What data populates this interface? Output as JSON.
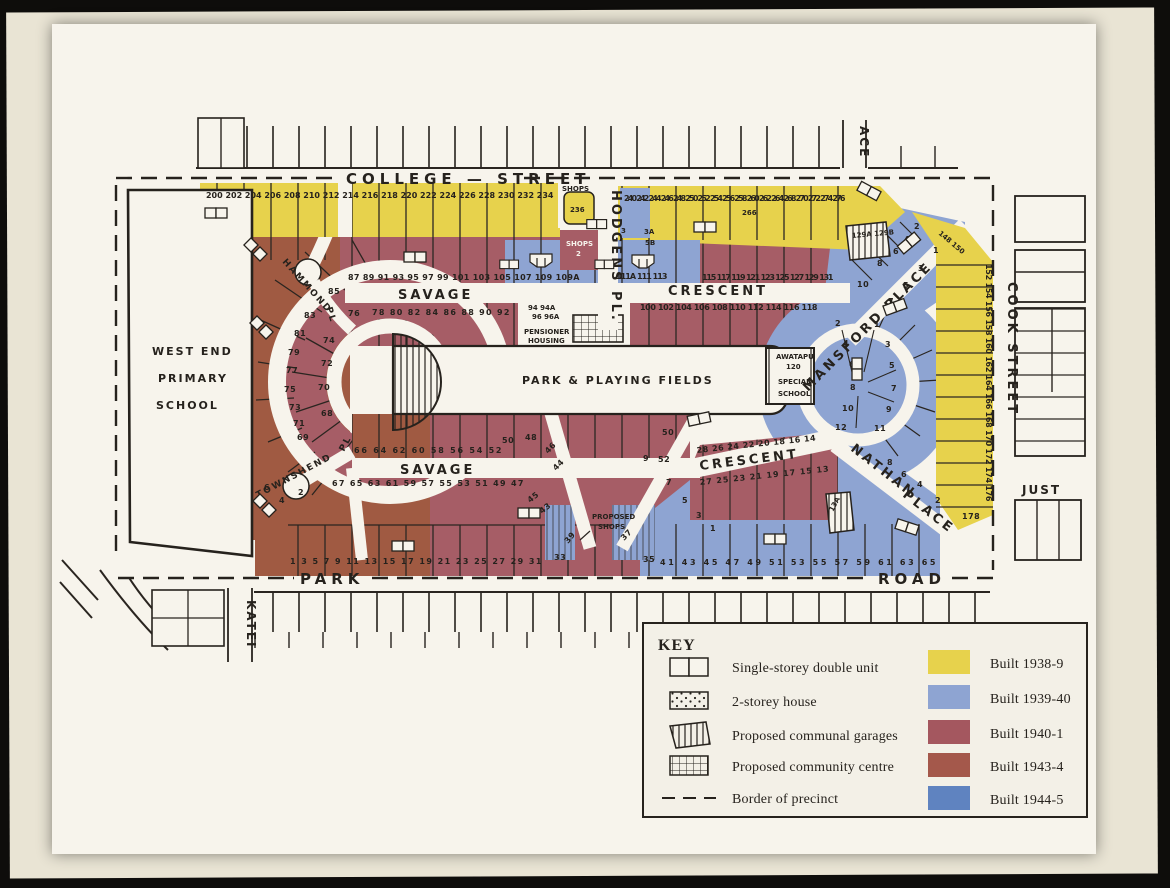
{
  "streets": {
    "college": "COLLEGE — STREET",
    "hodgens": "HODGENS PL.",
    "mansford": "MANSFORD PLACE",
    "cook": "COOK STREET",
    "savage_upper": "SAVAGE",
    "crescent_upper": "CRESCENT",
    "savage_lower": "SAVAGE",
    "crescent_lower": "CRESCENT",
    "nathan_word1": "NATHAN",
    "nathan_word2": "PLACE",
    "hammond": "HAMMOND",
    "hammond_pl": "PL",
    "townshend": "TOWNSHEND",
    "townshend_pl": "PL",
    "park": "PARK",
    "road": "ROAD",
    "katei": "KATEI",
    "just": "JUST",
    "ace_partial": "ACE"
  },
  "labels": {
    "school_line1": "WEST END",
    "school_line2": "PRIMARY",
    "school_line3": "SCHOOL",
    "park_fields": "PARK & PLAYING FIELDS",
    "pensioner_line1": "PENSIONER",
    "pensioner_line2": "HOUSING",
    "awatapu_line1": "AWATAPU",
    "awatapu_line2": "120",
    "awatapu_line3": "SPECIAL",
    "awatapu_line4": "SCHOOL",
    "proposed_shops_line1": "PROPOSED",
    "proposed_shops_line2": "SHOPS",
    "shops_north": "SHOPS",
    "shops2_line1": "SHOPS",
    "shops2_line2": "2",
    "lot_236": "236",
    "lot_266": "266"
  },
  "lots": {
    "college_west": [
      "200",
      "202",
      "204",
      "206",
      "208",
      "210",
      "212",
      "214",
      "216",
      "218",
      "220",
      "222",
      "224",
      "226",
      "228",
      "230",
      "232",
      "234"
    ],
    "college_east": [
      "240",
      "242",
      "244",
      "246",
      "248",
      "250",
      "252",
      "254",
      "256",
      "258",
      "260",
      "262",
      "264",
      "268",
      "270",
      "272",
      "274",
      "276"
    ],
    "cook_top": [
      "148",
      "150"
    ],
    "cook_strip": [
      "152",
      "154",
      "156",
      "158",
      "160",
      "162",
      "164",
      "166",
      "168",
      "170",
      "172",
      "174",
      "176"
    ],
    "cook_bottom": "178",
    "savage_n_outer_w": [
      "87",
      "89",
      "91",
      "93",
      "95",
      "97",
      "99",
      "101",
      "103",
      "105",
      "107",
      "109",
      "109A"
    ],
    "savage_n_outer_m": [
      "111A",
      "111",
      "113"
    ],
    "savage_n_outer_e": [
      "115",
      "117",
      "119",
      "121",
      "123",
      "125",
      "127",
      "129",
      "131"
    ],
    "garage_lots_n": [
      "129A",
      "129B"
    ],
    "savage_n_inner": [
      "78",
      "80",
      "82",
      "84",
      "86",
      "88",
      "90",
      "92"
    ],
    "pensioner_row1": [
      "94",
      "94A"
    ],
    "pensioner_row2": [
      "96",
      "96A"
    ],
    "crescent_n_inner": [
      "100",
      "102",
      "104",
      "106",
      "108",
      "110",
      "112",
      "114",
      "116",
      "118"
    ],
    "ring_w_outer": [
      "85",
      "83",
      "81",
      "79",
      "77",
      "75",
      "73",
      "71",
      "69"
    ],
    "ring_w_inner": [
      "76",
      "74",
      "72",
      "70",
      "68"
    ],
    "savage_s_inner": [
      "66",
      "64",
      "62",
      "60",
      "58",
      "56",
      "54",
      "52"
    ],
    "spur_w": [
      "50",
      "48"
    ],
    "spur_e": [
      "50",
      "52"
    ],
    "diag_se": [
      "46",
      "44"
    ],
    "savage_s_outer": [
      "67",
      "65",
      "63",
      "61",
      "59",
      "57",
      "55",
      "53",
      "51",
      "49",
      "47"
    ],
    "diag_s_outer": [
      "45",
      "43"
    ],
    "crescent_s_inner": [
      "28",
      "26",
      "24",
      "22",
      "20",
      "18",
      "16",
      "14"
    ],
    "crescent_s_outer": [
      "27",
      "25",
      "23",
      "21",
      "19",
      "17",
      "15",
      "13"
    ],
    "garage_lot_s": "13A",
    "park_row_west": [
      "1",
      "3",
      "5",
      "7",
      "9",
      "11",
      "13",
      "15",
      "17",
      "19",
      "21",
      "23",
      "25",
      "27",
      "29",
      "31"
    ],
    "shops_corner": [
      "39",
      "37",
      "35",
      "33"
    ],
    "park_row_east": [
      "41",
      "43",
      "45",
      "47",
      "49",
      "51",
      "53",
      "55",
      "57",
      "59",
      "61",
      "63",
      "65"
    ],
    "nathan_sw": [
      "9",
      "7",
      "5",
      "3",
      "1"
    ],
    "nathan_ne": [
      "8",
      "6",
      "4",
      "2"
    ],
    "mansford_nw": [
      "10",
      "8",
      "6",
      "4",
      "2"
    ],
    "mansford_se": [
      "1",
      "3",
      "5",
      "7"
    ],
    "ring_e_inner": [
      "2",
      "4",
      "6",
      "8",
      "10",
      "12"
    ],
    "ring_e_outer": [
      "1",
      "3",
      "5",
      "7",
      "9",
      "11"
    ],
    "hodgens_east": [
      "3",
      "3A",
      "5B"
    ],
    "townshend_lots": [
      "6",
      "4",
      "2"
    ]
  },
  "key": {
    "title": "KEY",
    "symbols": [
      {
        "name": "single-storey-double-unit",
        "label": "Single-storey double unit"
      },
      {
        "name": "two-storey-house",
        "label": "2-storey house"
      },
      {
        "name": "proposed-communal-garages",
        "label": "Proposed communal garages"
      },
      {
        "name": "proposed-community-centre",
        "label": "Proposed community centre"
      },
      {
        "name": "border-of-precinct",
        "label": "Border of precinct"
      }
    ],
    "builds": [
      {
        "label": "Built 1938-9",
        "color": "#e7d24c"
      },
      {
        "label": "Built 1939-40",
        "color": "#8ea4d2"
      },
      {
        "label": "Built 1940-1",
        "color": "#a4575f"
      },
      {
        "label": "Built 1943-4",
        "color": "#a4584b"
      },
      {
        "label": "Built 1944-5",
        "color": "#5f83c0"
      }
    ]
  },
  "colors": {
    "paper": "#f7f4ec",
    "mat": "#e9e4d4",
    "ink": "#26221d",
    "built_1938_9": "#e7d24c",
    "built_1939_40": "#8ea4d2",
    "built_1940_1": "#a4575f",
    "built_1943_4": "#a4584b",
    "built_1944_5": "#5f83c0"
  }
}
